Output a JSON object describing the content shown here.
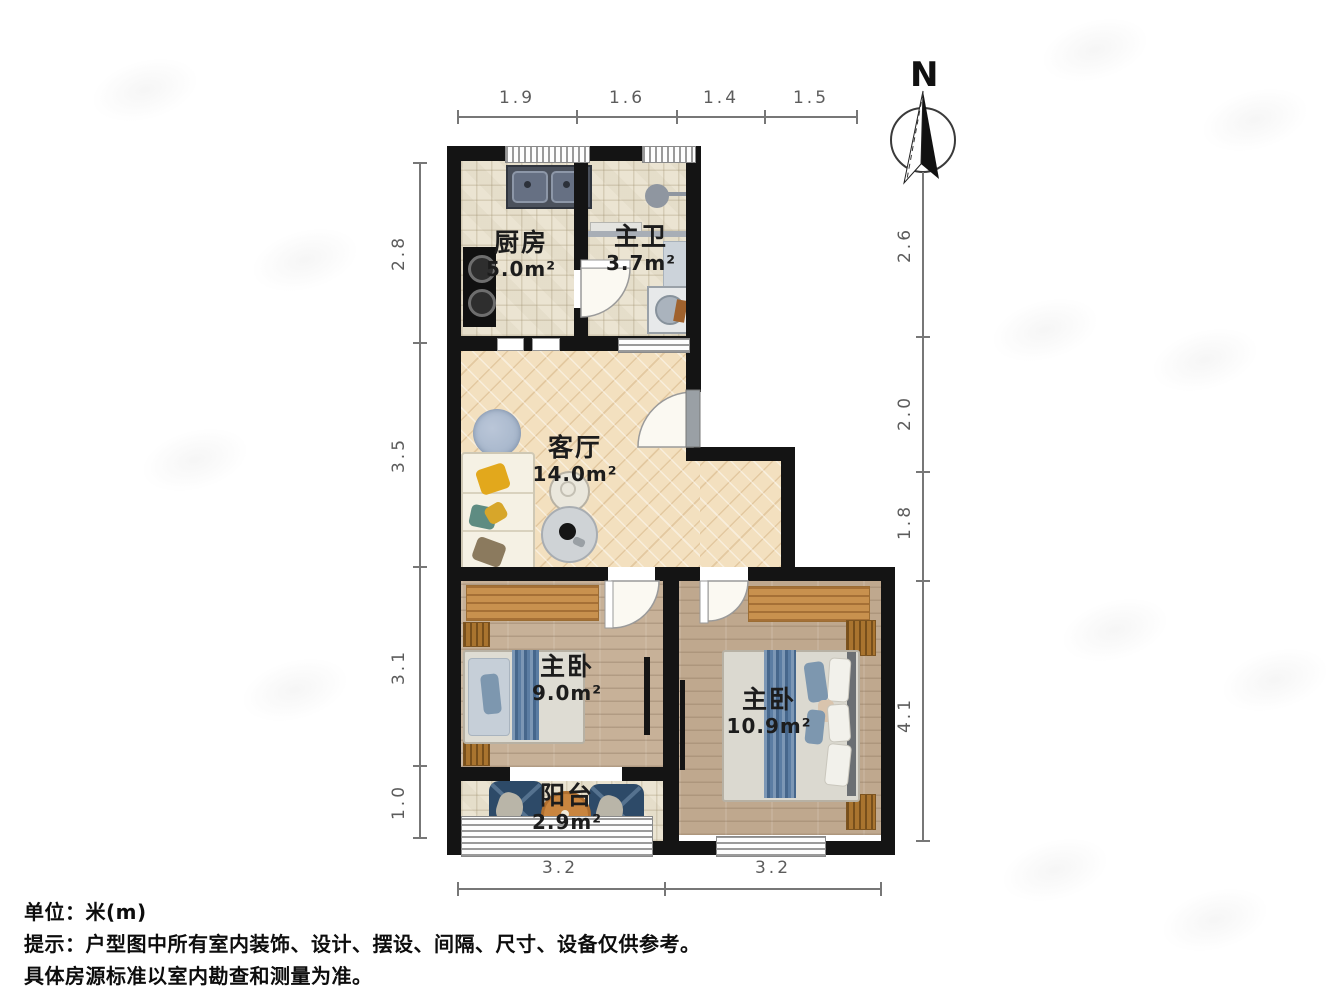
{
  "compass": {
    "label": "N"
  },
  "rooms": [
    {
      "id": "kitchen",
      "name": "厨房",
      "area": "5.0m²"
    },
    {
      "id": "bathroom",
      "name": "主卫",
      "area": "3.7m²"
    },
    {
      "id": "living_room",
      "name": "客厅",
      "area": "14.0m²"
    },
    {
      "id": "bedroom_left",
      "name": "主卧",
      "area": "9.0m²"
    },
    {
      "id": "bedroom_right",
      "name": "主卧",
      "area": "10.9m²"
    },
    {
      "id": "balcony",
      "name": "阳台",
      "area": "2.9m²"
    }
  ],
  "dimensions": {
    "top": [
      "1.9",
      "1.6",
      "1.4",
      "1.5"
    ],
    "left": [
      "2.8",
      "3.5",
      "3.1",
      "1.0"
    ],
    "right": [
      "2.6",
      "2.0",
      "1.8",
      "4.1"
    ],
    "bottom": [
      "3.2",
      "3.2"
    ]
  },
  "footer": {
    "line1": "单位：米(m)",
    "line2": "提示：户型图中所有室内装饰、设计、摆设、间隔、尺寸、设备仅供参考。",
    "line3": "具体房源标准以室内勘查和测量为准。"
  },
  "colors": {
    "wall": "#141414",
    "living_floor": "#f3e0bf",
    "tile_floor": "#ebe4d2",
    "bedroom_floor_left": "#c7b198",
    "bedroom_floor_right": "#bfa88e",
    "bed_runner_blue": "#5b7da3",
    "balcony_chair_blue": "#2d4a68",
    "desk_wood": "#c8914e",
    "dimension_text": "#5c5c5c",
    "label_text": "#1c1c1c"
  }
}
